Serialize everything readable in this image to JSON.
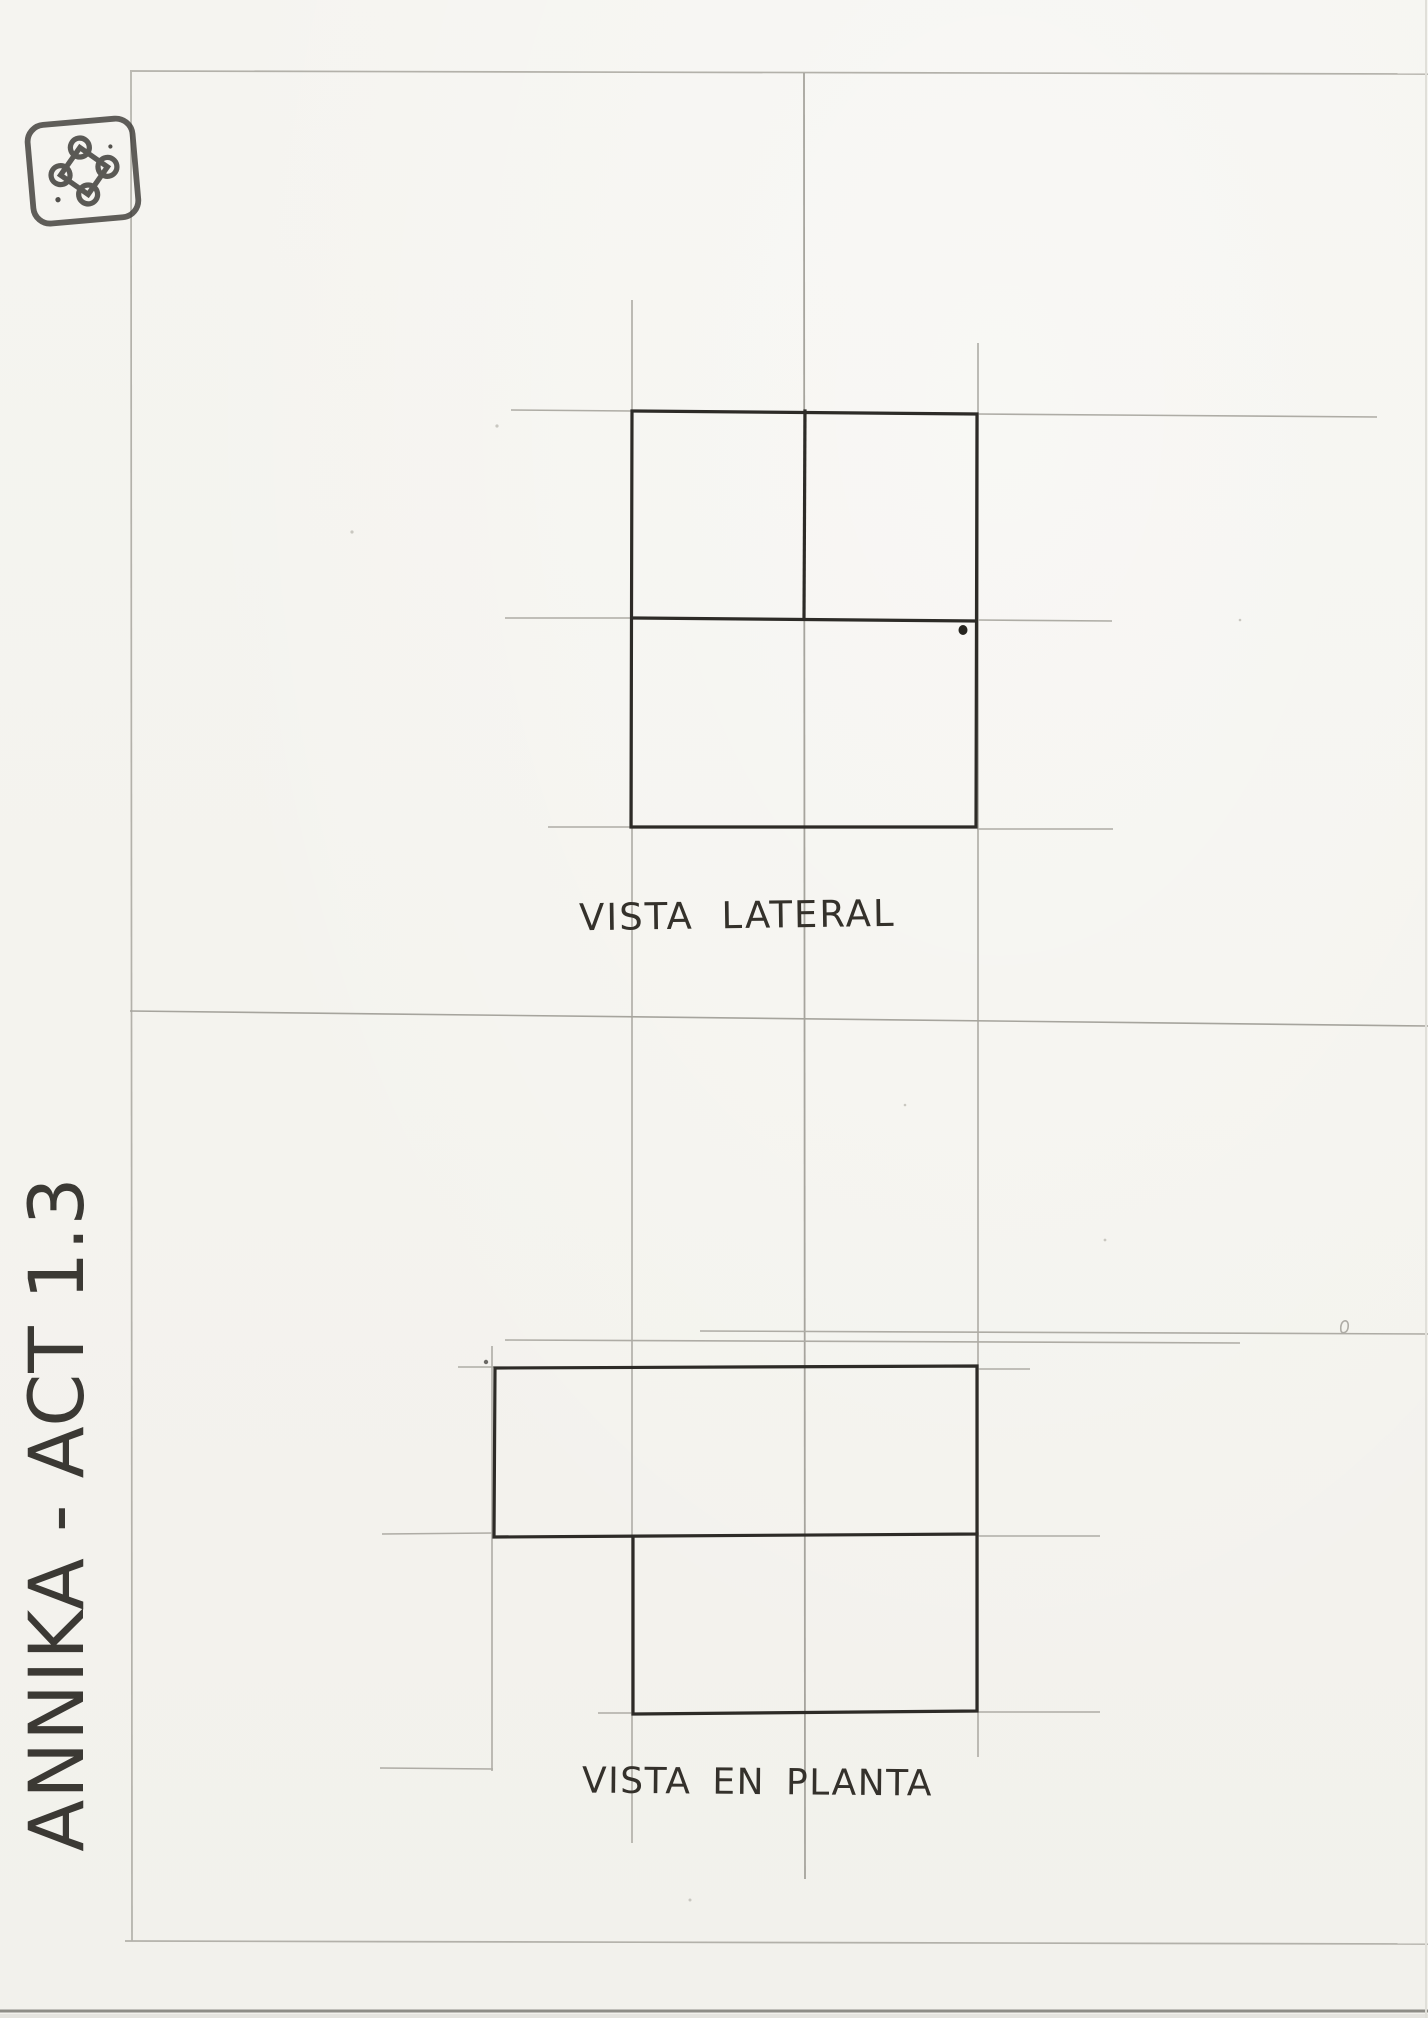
{
  "sheet": {
    "kind_label": "hand-drawn orthographic projection worksheet"
  },
  "captions": {
    "lateral": "VISTA LATERAL",
    "plan": "VISTA EN PLANTA"
  },
  "signature": {
    "text": "ANNIKA - ACT 1.3"
  },
  "stamp": {
    "icon_name": "bowen-knot-stamp-icon"
  },
  "colors": {
    "paper": "#f4f3ee",
    "ink": "#2d2b27",
    "pencil_guide": "#b3b1aa",
    "handwriting": "#3b3934",
    "page_edge": "#8e8d87"
  }
}
